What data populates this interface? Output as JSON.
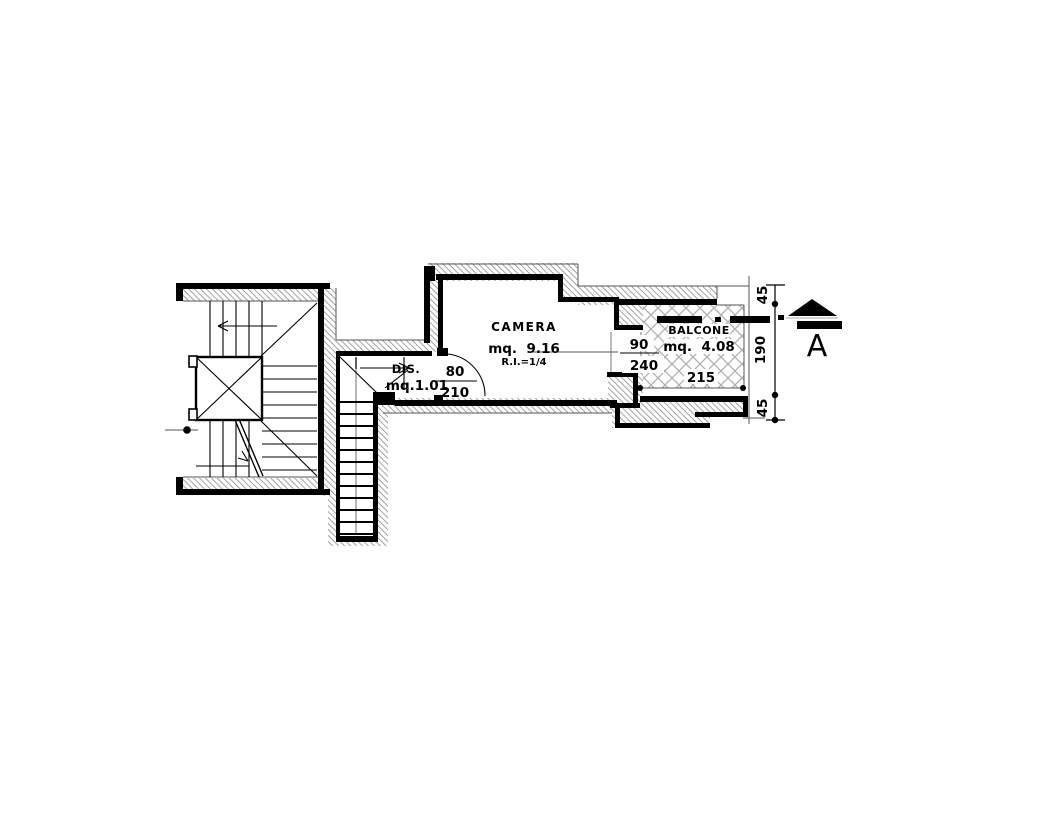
{
  "rooms": {
    "camera": {
      "name": "CAMERA",
      "area": "mq.  9.16",
      "ratio": "R.I.=1/4"
    },
    "dis": {
      "name": "DIS.",
      "area": "mq.1.01"
    },
    "balcone": {
      "name": "BALCONE",
      "area": "mq.  4.08"
    }
  },
  "openings": {
    "door": {
      "width": "80",
      "height": "210"
    },
    "window": {
      "width": "90",
      "height": "240"
    }
  },
  "dimensions": {
    "balcony_width": "215",
    "right_chain": {
      "top": "45",
      "middle": "190",
      "bottom": "45"
    }
  },
  "section_marker": {
    "letter": "A"
  },
  "colors": {
    "ink": "#000000",
    "wall_hatch": "#999999",
    "balcony_hatch": "#b0b0b0",
    "section_letter": "#b3b9c0"
  }
}
